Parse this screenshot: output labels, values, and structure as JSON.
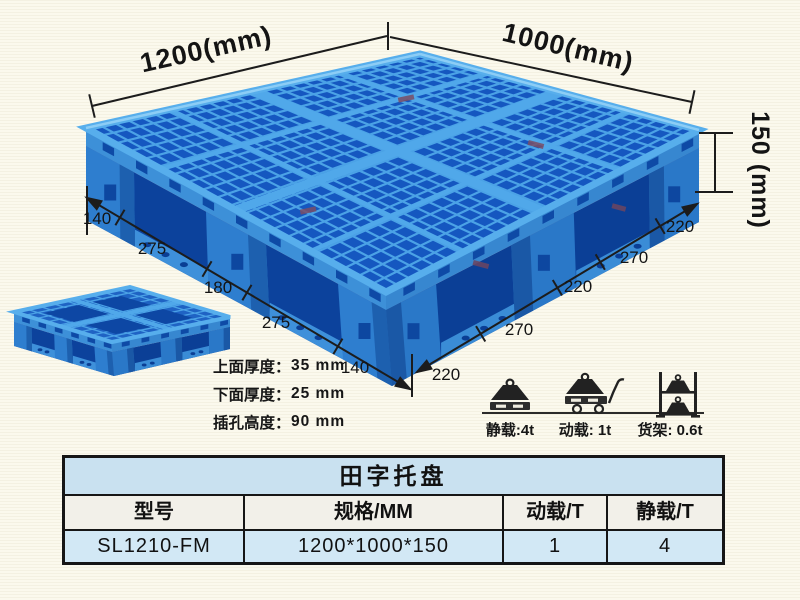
{
  "page": {
    "background_color": "#fbf9ed"
  },
  "colors": {
    "pallet_blue": "#2e7ecf",
    "pallet_blue_dark": "#1557c0",
    "pallet_blue_deep": "#0c429c",
    "pallet_mesh_line": "#4ba2e6",
    "pallet_rim": "#57aeec",
    "dimension_line": "#1c1c1c",
    "table_title_bg": "#c9e1f0",
    "table_header_bg": "#f2f0e9",
    "table_data_bg": "#d2e8f5",
    "table_border": "#161616"
  },
  "dimensions": {
    "top_left_label": "1200(mm)",
    "top_right_label": "1000(mm)",
    "height_label": "150 (mm)",
    "left_chain": [
      "140",
      "275",
      "180",
      "275",
      "140"
    ],
    "right_chain": [
      "220",
      "270",
      "220",
      "270",
      "220"
    ]
  },
  "thickness_notes": [
    {
      "label": "上面厚度：",
      "value": "35 mm"
    },
    {
      "label": "下面厚度：",
      "value": "25 mm"
    },
    {
      "label": "插孔高度：",
      "value": "90 mm"
    }
  ],
  "load_ratings": [
    {
      "icon": "static-load-weight-icon",
      "label": "静载:4t"
    },
    {
      "icon": "dynamic-load-trolley-icon",
      "label": "动载: 1t"
    },
    {
      "icon": "rack-load-shelf-icon",
      "label": "货架: 0.6t"
    }
  ],
  "table": {
    "title": "田字托盘",
    "headers": [
      "型号",
      "规格/MM",
      "动载/T",
      "静载/T"
    ],
    "rows": [
      [
        "SL1210-FM",
        "1200*1000*150",
        "1",
        "4"
      ]
    ]
  }
}
